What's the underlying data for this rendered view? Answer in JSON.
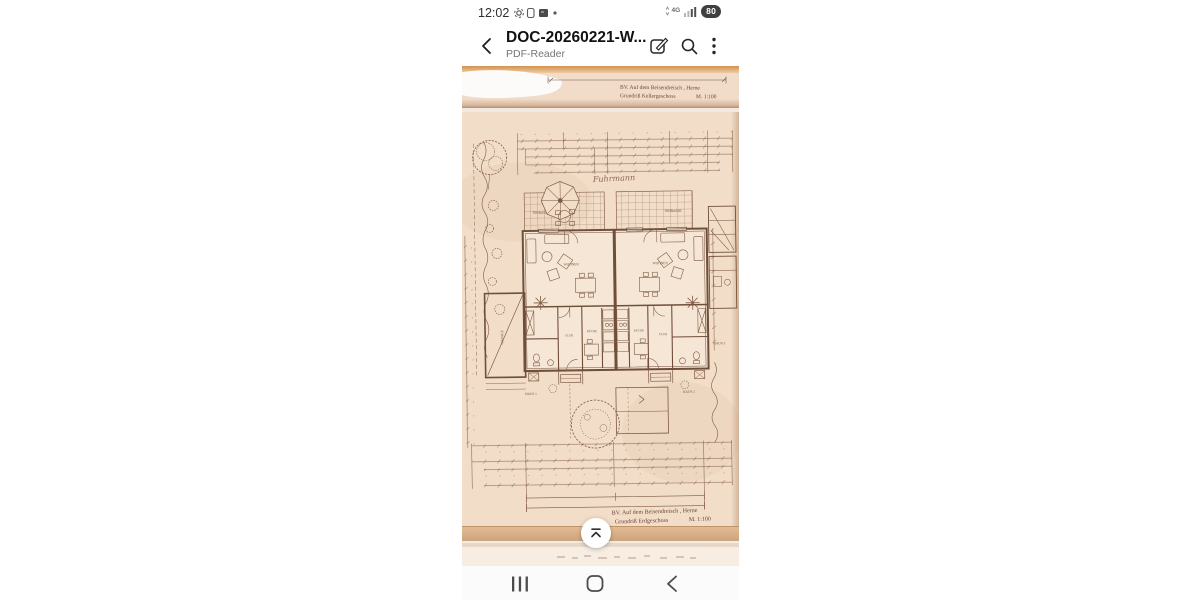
{
  "status_bar": {
    "time": "12:02",
    "network_label": "4G",
    "battery_percent": "80",
    "left_icons": [
      "screen-record-icon",
      "sim-icon",
      "screenshot-icon",
      "notification-dot"
    ],
    "right_icons": [
      "network-4g-icon",
      "signal-strength-icon",
      "battery-pill"
    ]
  },
  "header": {
    "title": "DOC-20260221-W...",
    "subtitle": "PDF-Reader",
    "icons": [
      "back-icon",
      "edit-icon",
      "search-icon",
      "more-menu-icon"
    ]
  },
  "document": {
    "previous_page": {
      "caption_line1": "BV.  Auf dem Beisendreisch , Herne",
      "caption_line2": "Grundriß Kellergeschoss",
      "caption_scale": "M. 1:100"
    },
    "current_page": {
      "handwritten_name": "Fuhrmann",
      "room_labels": {
        "terrace_left": "TERRASSE",
        "terrace_right": "TERRASSE",
        "living_left": "WOHNEN",
        "living_right": "WOHNEN",
        "hall_left": "FLUR",
        "hall_right": "FLUR",
        "kitchen_left": "KÜCHE",
        "kitchen_right": "KÜCHE",
        "garage": "GARAGE",
        "house_1": "HAUS 1",
        "house_2": "HAUS 2",
        "house_3": "HAUS 3"
      },
      "caption_line1": "BV.  Auf dem Beisendreisch , Herne",
      "caption_line2": "Grundriß Erdgeschoss",
      "caption_scale": "M. 1:100"
    }
  },
  "scroll_button": {
    "icon": "chevron-up-icon"
  },
  "nav_bar": {
    "icons": [
      "recents-icon",
      "home-icon",
      "back-icon"
    ]
  },
  "colors": {
    "paper": "#f2ddc9",
    "ink": "#7b5844",
    "top_band": "#d79a62",
    "battery_pill": "#404040"
  }
}
